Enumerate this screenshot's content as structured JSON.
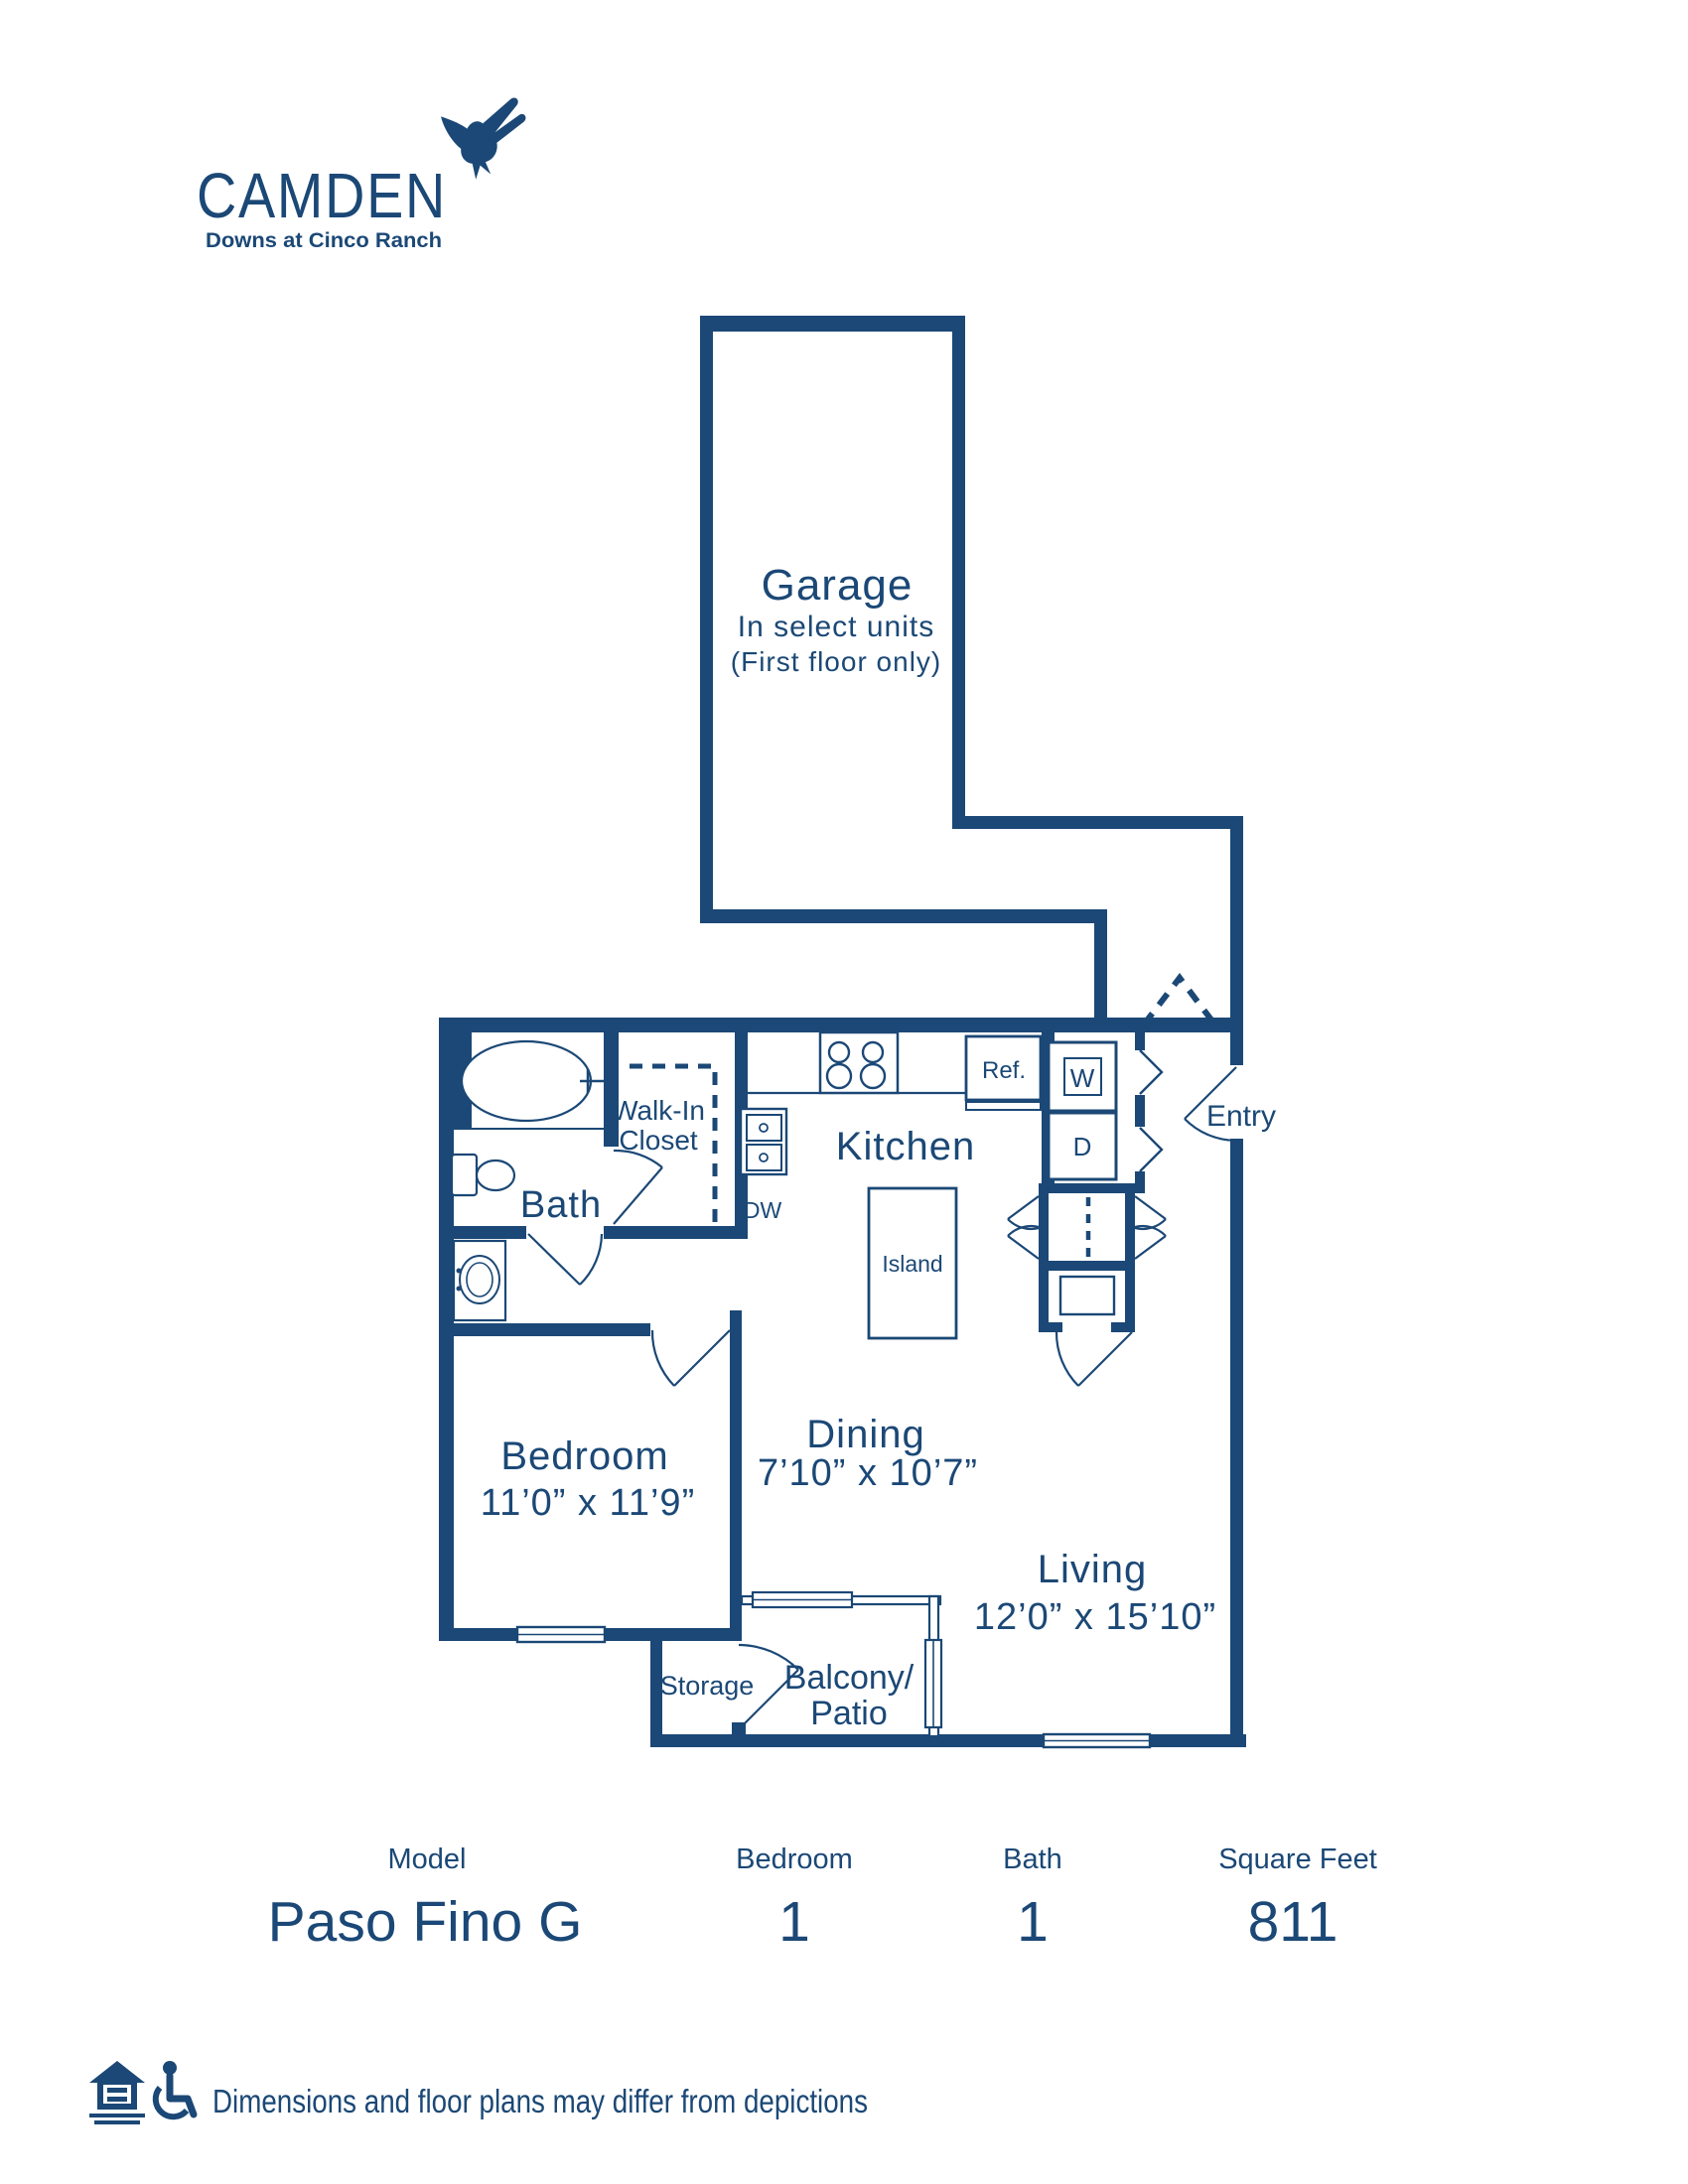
{
  "colors": {
    "navy": "#1b4876",
    "background": "#ffffff"
  },
  "logo": {
    "brand": "CAMDEN",
    "community": "Downs at Cinco Ranch",
    "icon": "hummingbird-icon"
  },
  "plan": {
    "garage": {
      "title": "Garage",
      "line2": "In select units",
      "line3": "(First floor only)"
    },
    "kitchen": "Kitchen",
    "walk_in_closet": {
      "line1": "Walk-In",
      "line2": "Closet"
    },
    "bath": "Bath",
    "bedroom": {
      "name": "Bedroom",
      "dims": "11’0” x 11’9”"
    },
    "dining": {
      "name": "Dining",
      "dims": "7’10” x 10’7”"
    },
    "living": {
      "name": "Living",
      "dims": "12’0” x 15’10”"
    },
    "balcony": {
      "line1": "Balcony/",
      "line2": "Patio"
    },
    "storage": "Storage",
    "entry": "Entry",
    "fixtures": {
      "ref": "Ref.",
      "island": "Island",
      "dw": "DW",
      "washer": "W",
      "dryer": "D"
    }
  },
  "summary": {
    "columns": [
      {
        "label": "Model",
        "value": "Paso Fino G"
      },
      {
        "label": "Bedroom",
        "value": "1"
      },
      {
        "label": "Bath",
        "value": "1"
      },
      {
        "label": "Square Feet",
        "value": "811"
      }
    ]
  },
  "footer": {
    "disclaimer": "Dimensions and floor plans may differ from depictions",
    "icons": [
      "equal-housing-icon",
      "accessible-icon"
    ]
  }
}
